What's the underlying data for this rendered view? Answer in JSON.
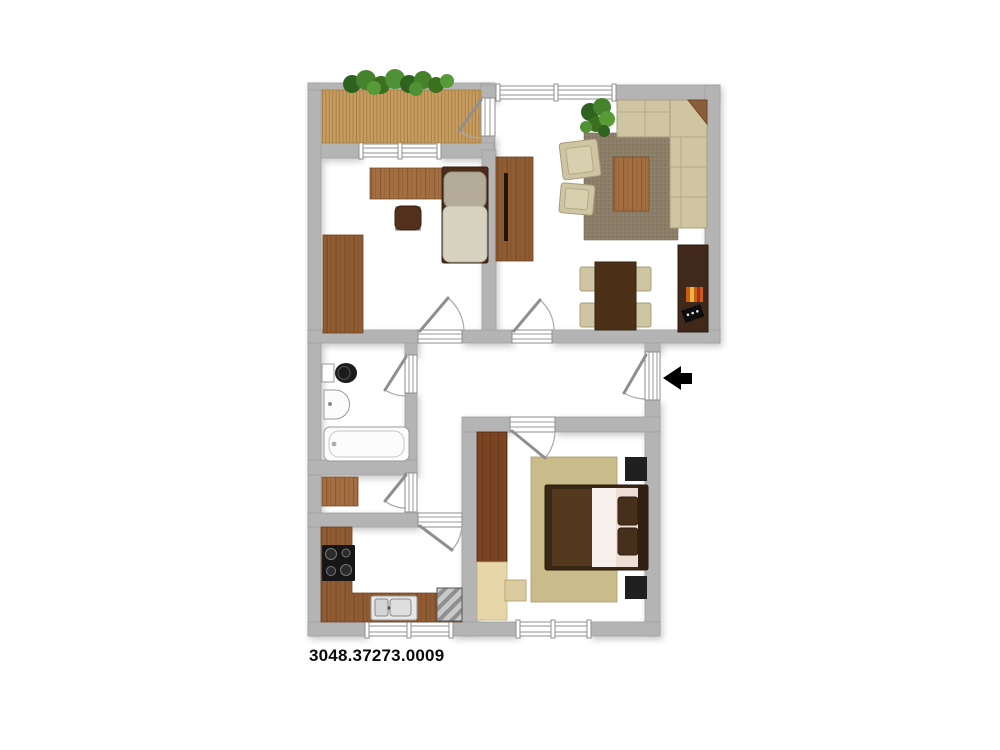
{
  "plan": {
    "label": "3048.37273.0009",
    "type": "apartment-floor-plan",
    "entrance": {
      "arrow_direction": "left",
      "location": "right-side-hallway"
    },
    "colors": {
      "wall_gray": "#b4b4b4",
      "floor_white": "#ffffff",
      "deck_wood": "#c79d5f",
      "plant_green": "#44822c",
      "wood_light": "#a26e42",
      "wood_mid": "#8f5c33",
      "wood_dark_redbrown": "#7d4423",
      "furniture_dark_brown": "#46301c",
      "upholstery_beige": "#cfc5a2",
      "living_rug_brown": "#8b7e68",
      "bedroom_rug_khaki": "#cabc8a",
      "wardrobe_beige": "#e6d6a8",
      "appliance_black": "#1a1a1a",
      "fixture_white": "#fcfcfc",
      "label_black": "#0a0a0a"
    },
    "rooms": [
      {
        "name": "balcony",
        "features": [
          "wood-deck",
          "plants",
          "balcony-door"
        ]
      },
      {
        "name": "living-room",
        "features": [
          "corner-sofa",
          "armchair",
          "armchair",
          "area-rug",
          "coffee-table",
          "plant",
          "dining-table",
          "four-dining-chairs",
          "sideboard",
          "tv",
          "tall-cabinet",
          "window"
        ]
      },
      {
        "name": "study-room",
        "features": [
          "desk",
          "office-chair",
          "single-bed",
          "wardrobe",
          "window"
        ]
      },
      {
        "name": "bathroom",
        "features": [
          "toilet",
          "washbasin",
          "bathtub",
          "door"
        ]
      },
      {
        "name": "storage-room",
        "features": [
          "cabinet",
          "door"
        ]
      },
      {
        "name": "kitchen",
        "features": [
          "l-shaped-counter",
          "stove",
          "sink",
          "refrigerator",
          "window",
          "door"
        ]
      },
      {
        "name": "bedroom",
        "features": [
          "double-bed",
          "nightstand",
          "nightstand",
          "wardrobe",
          "side-unit",
          "area-rug",
          "window",
          "door"
        ]
      },
      {
        "name": "hallway",
        "features": [
          "entrance-door",
          "entrance-arrow"
        ]
      }
    ]
  }
}
